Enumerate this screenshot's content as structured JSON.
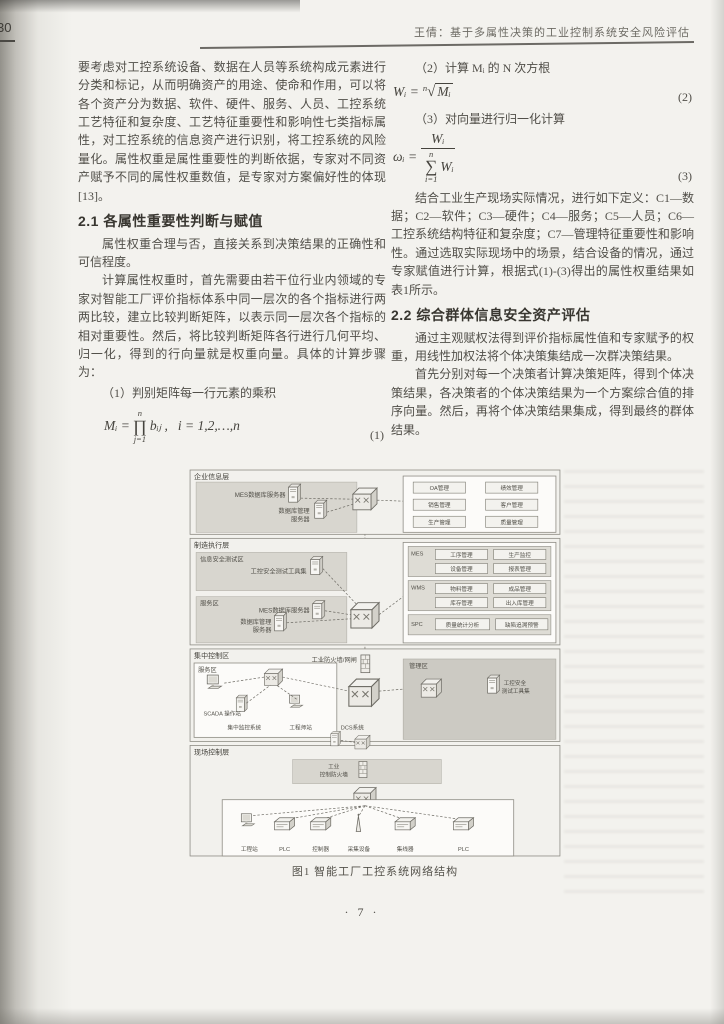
{
  "page": {
    "margin_page_number": "30",
    "header_title": "王倩：基于多属性决策的工业控制系统安全风险评估",
    "footer_page_number": "· 7 ·"
  },
  "left_column": {
    "para_continuation": "要考虑对工控系统设备、数据在人员等系统构成元素进行分类和标记，从而明确资产的用途、使命和作用，可以将各个资产分为数据、软件、硬件、服务、人员、工控系统工艺特征和复杂度、工艺特征重要性和影响性七类指标属性，对工控系统的信息资产进行识别，将工控系统的风险量化。属性权重是属性重要性的判断依据，专家对不同资产赋予不同的属性权重数值，是专家对方案偏好性的体现[13]。",
    "heading_2_1": "2.1 各属性重要性判断与赋值",
    "para_weight": "属性权重合理与否，直接关系到决策结果的正确性和可信程度。",
    "para_calc": "计算属性权重时，首先需要由若干位行业内领域的专家对智能工厂评价指标体系中同一层次的各个指标进行两两比较，建立比较判断矩阵，以表示同一层次各个指标的相对重要性。然后，将比较判断矩阵各行进行几何平均、归一化，得到的行向量就是权重向量。具体的计算步骤为：",
    "step1_label": "（1）判别矩阵每一行元素的乘积"
  },
  "right_column": {
    "step2_label": "（2）计算 Mᵢ 的 N 次方根",
    "step3_label": "（3）对向量进行归一化计算",
    "para_define": "结合工业生产现场实际情况，进行如下定义：C1—数据；C2—软件；C3—硬件；C4—服务；C5—人员；C6—工控系统结构特征和复杂度；C7—管理特征重要性和影响性。通过选取实际现场中的场景，结合设备的情况，通过专家赋值进行计算，根据式(1)-(3)得出的属性权重结果如表1所示。",
    "heading_2_2": "2.2 综合群体信息安全资产评估",
    "para_group1": "通过主观赋权法得到评价指标属性值和专家赋予的权重，用线性加权法将个体决策集结成一次群决策结果。",
    "para_group2": "首先分别对每一个决策者计算决策矩阵，得到个体决策结果，各决策者的个体决策结果为一个方案综合值的排序向量。然后，再将个体决策结果集成，得到最终的群体结果。"
  },
  "formulas": {
    "f1": {
      "lhs": "Mᵢ =",
      "op": "∏",
      "sup": "n",
      "sub": "j=1",
      "rhs": "bᵢⱼ ,",
      "cond": "i = 1,2,…,n",
      "number": "(1)"
    },
    "f2": {
      "lhs": "Wᵢ =",
      "index": "n",
      "sqrt": "√",
      "radicand": "Mᵢ",
      "number": "(2)"
    },
    "f3": {
      "lhs": "ωᵢ =",
      "num": "Wᵢ",
      "op": "∑",
      "sup": "n",
      "sub": "i=1",
      "den_tail": "Wᵢ",
      "number": "(3)"
    }
  },
  "figure": {
    "caption": "图1 智能工厂工控系统网络结构",
    "layer1": {
      "title": "企业信息层",
      "server_db": "MES数据库服务器",
      "server_mgmt_line1": "数据库管理",
      "server_mgmt_line2": "服务器",
      "erp_items": [
        "OA管理",
        "绩效管理",
        "销售管理",
        "客户管理",
        "生产管理",
        "质量管理"
      ]
    },
    "layer2": {
      "title": "制造执行层",
      "security_zone": "信息安全测试区",
      "security_tool": "工控安全测试工具集",
      "service_zone": "服务区",
      "server_db": "MES数据库服务器",
      "server_mgmt_line1": "数据库管理",
      "server_mgmt_line2": "服务器",
      "group_mes": {
        "name": "MES",
        "items": [
          "工序管理",
          "生产监控",
          "设备管理",
          "报表管理"
        ]
      },
      "group_wms": {
        "name": "WMS",
        "items": [
          "物料管理",
          "成品管理",
          "库存管理",
          "出入库管理"
        ]
      },
      "group_spc": {
        "name": "SPC",
        "items": [
          "质量统计分析",
          "缺陷追溯预警"
        ]
      }
    },
    "layer3": {
      "title": "集中控制区",
      "firewall_label": "工业防火墙/网闸",
      "service_zone": "服务区",
      "scada_station": "SCADA 操作站",
      "central_monitor": "集中监控系统",
      "engineer_station": "工程师站",
      "manage_zone": "管理区",
      "manage_tool_line1": "工控安全",
      "manage_tool_line2": "测试工具集"
    },
    "layer4": {
      "title": "现场控制层",
      "dcs_label": "DCS系统",
      "band_line1": "工业",
      "band_line2": "控制防火墙",
      "devices": [
        "工程站",
        "PLC",
        "控制器",
        "采集设备",
        "集线器",
        "PLC"
      ]
    }
  }
}
